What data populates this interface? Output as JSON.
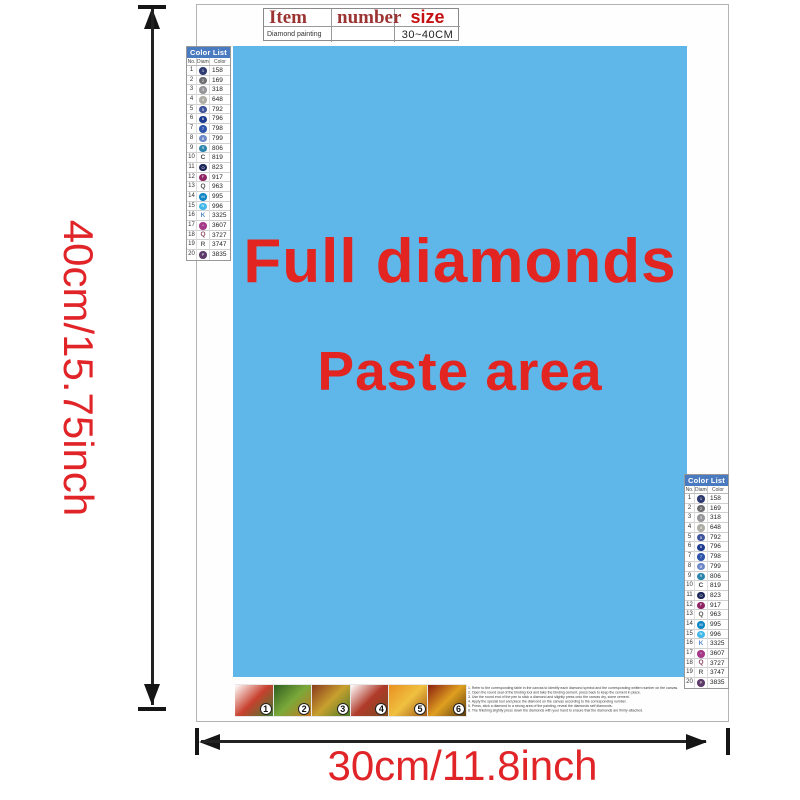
{
  "header_table": {
    "col_item": "Item",
    "col_number": "number",
    "col_size": "size",
    "row_item": "Diamond painting",
    "row_number": "",
    "row_size": "30~40CM"
  },
  "paste_area": {
    "line1": "Full diamonds",
    "line2": "Paste area",
    "bg": "#5fb6e8",
    "text_color": "#e32521"
  },
  "dimensions": {
    "height_label": "40cm/15.75inch",
    "width_label": "30cm/11.8inch",
    "label_color": "#e02428"
  },
  "color_list": {
    "title": "Color List",
    "header_bg": "#4a7ac0",
    "columns": {
      "no": "No.",
      "diamond": "Diamond",
      "color": "Color"
    },
    "rows": [
      {
        "no": "1",
        "code": "158",
        "symbol_type": "circle",
        "symbol_color": "#2e3a72",
        "glyph": "1"
      },
      {
        "no": "2",
        "code": "169",
        "symbol_type": "circle",
        "symbol_color": "#6e6e72",
        "glyph": "2"
      },
      {
        "no": "3",
        "code": "318",
        "symbol_type": "circle",
        "symbol_color": "#96969a",
        "glyph": "3"
      },
      {
        "no": "4",
        "code": "648",
        "symbol_type": "circle",
        "symbol_color": "#adada5",
        "glyph": "4"
      },
      {
        "no": "5",
        "code": "792",
        "symbol_type": "circle",
        "symbol_color": "#40549e",
        "glyph": "5"
      },
      {
        "no": "6",
        "code": "796",
        "symbol_type": "circle",
        "symbol_color": "#1c3a90",
        "glyph": "6"
      },
      {
        "no": "7",
        "code": "798",
        "symbol_type": "circle",
        "symbol_color": "#2f55ab",
        "glyph": "7"
      },
      {
        "no": "8",
        "code": "799",
        "symbol_type": "circle",
        "symbol_color": "#6d89c9",
        "glyph": "8"
      },
      {
        "no": "9",
        "code": "806",
        "symbol_type": "circle",
        "symbol_color": "#2c85ad",
        "glyph": "9"
      },
      {
        "no": "10",
        "code": "819",
        "symbol_type": "letter",
        "symbol_color": "#444444",
        "letter": "C"
      },
      {
        "no": "11",
        "code": "823",
        "symbol_type": "circle",
        "symbol_color": "#1a2558",
        "glyph": "O"
      },
      {
        "no": "12",
        "code": "917",
        "symbol_type": "circle",
        "symbol_color": "#8f2563",
        "glyph": "F"
      },
      {
        "no": "13",
        "code": "963",
        "symbol_type": "letter",
        "symbol_color": "#555555",
        "letter": "Q"
      },
      {
        "no": "14",
        "code": "995",
        "symbol_type": "circle",
        "symbol_color": "#0e85c4",
        "glyph": "M"
      },
      {
        "no": "15",
        "code": "996",
        "symbol_type": "circle",
        "symbol_color": "#41b7e9",
        "glyph": "N"
      },
      {
        "no": "16",
        "code": "3325",
        "symbol_type": "letter",
        "symbol_color": "#5a8cc8",
        "letter": "K"
      },
      {
        "no": "17",
        "code": "3607",
        "symbol_type": "circle",
        "symbol_color": "#a53a88",
        "glyph": "*"
      },
      {
        "no": "18",
        "code": "3727",
        "symbol_type": "letter",
        "symbol_color": "#8e4a63",
        "letter": "Q"
      },
      {
        "no": "19",
        "code": "3747",
        "symbol_type": "letter",
        "symbol_color": "#666666",
        "letter": "R"
      },
      {
        "no": "20",
        "code": "3835",
        "symbol_type": "circle",
        "symbol_color": "#5d3a68",
        "glyph": "P"
      }
    ]
  },
  "steps": {
    "items": [
      {
        "num": "1",
        "colors": [
          "#ffffff",
          "#c8402e",
          "#3e7e30"
        ]
      },
      {
        "num": "2",
        "colors": [
          "#2e5e20",
          "#7aa83a",
          "#c87820"
        ]
      },
      {
        "num": "3",
        "colors": [
          "#8a3a1e",
          "#c8a02e",
          "#4a7a28"
        ]
      },
      {
        "num": "4",
        "colors": [
          "#ffffff",
          "#b03a2a",
          "#7a4a1e"
        ]
      },
      {
        "num": "5",
        "colors": [
          "#e89020",
          "#f0c040",
          "#a05818"
        ]
      },
      {
        "num": "6",
        "colors": [
          "#8a1e10",
          "#e0a020",
          "#5a3a10"
        ]
      }
    ]
  },
  "instructions": {
    "lines": [
      "1. Refer to the corresponding table in the canvas to identify each diamond symbol and the corresponding written number on the canvas.",
      "2. Open the round seal of the binding tool and take the binding cement, press back to keep the cement in place.",
      "3. Use the round end of the pen to stick a diamond and slightly press onto the canvas dry, some cement.",
      "4. Apply the special tool and place the diamond on the canvas according to the corresponding number.",
      "5. Press, stick a diamond to a strong area of the painting, reveal the diamonds self diamonds.",
      "6. The finishing slightly press down the diamonds with your hand to ensure that the diamonds are firmly attached."
    ]
  }
}
